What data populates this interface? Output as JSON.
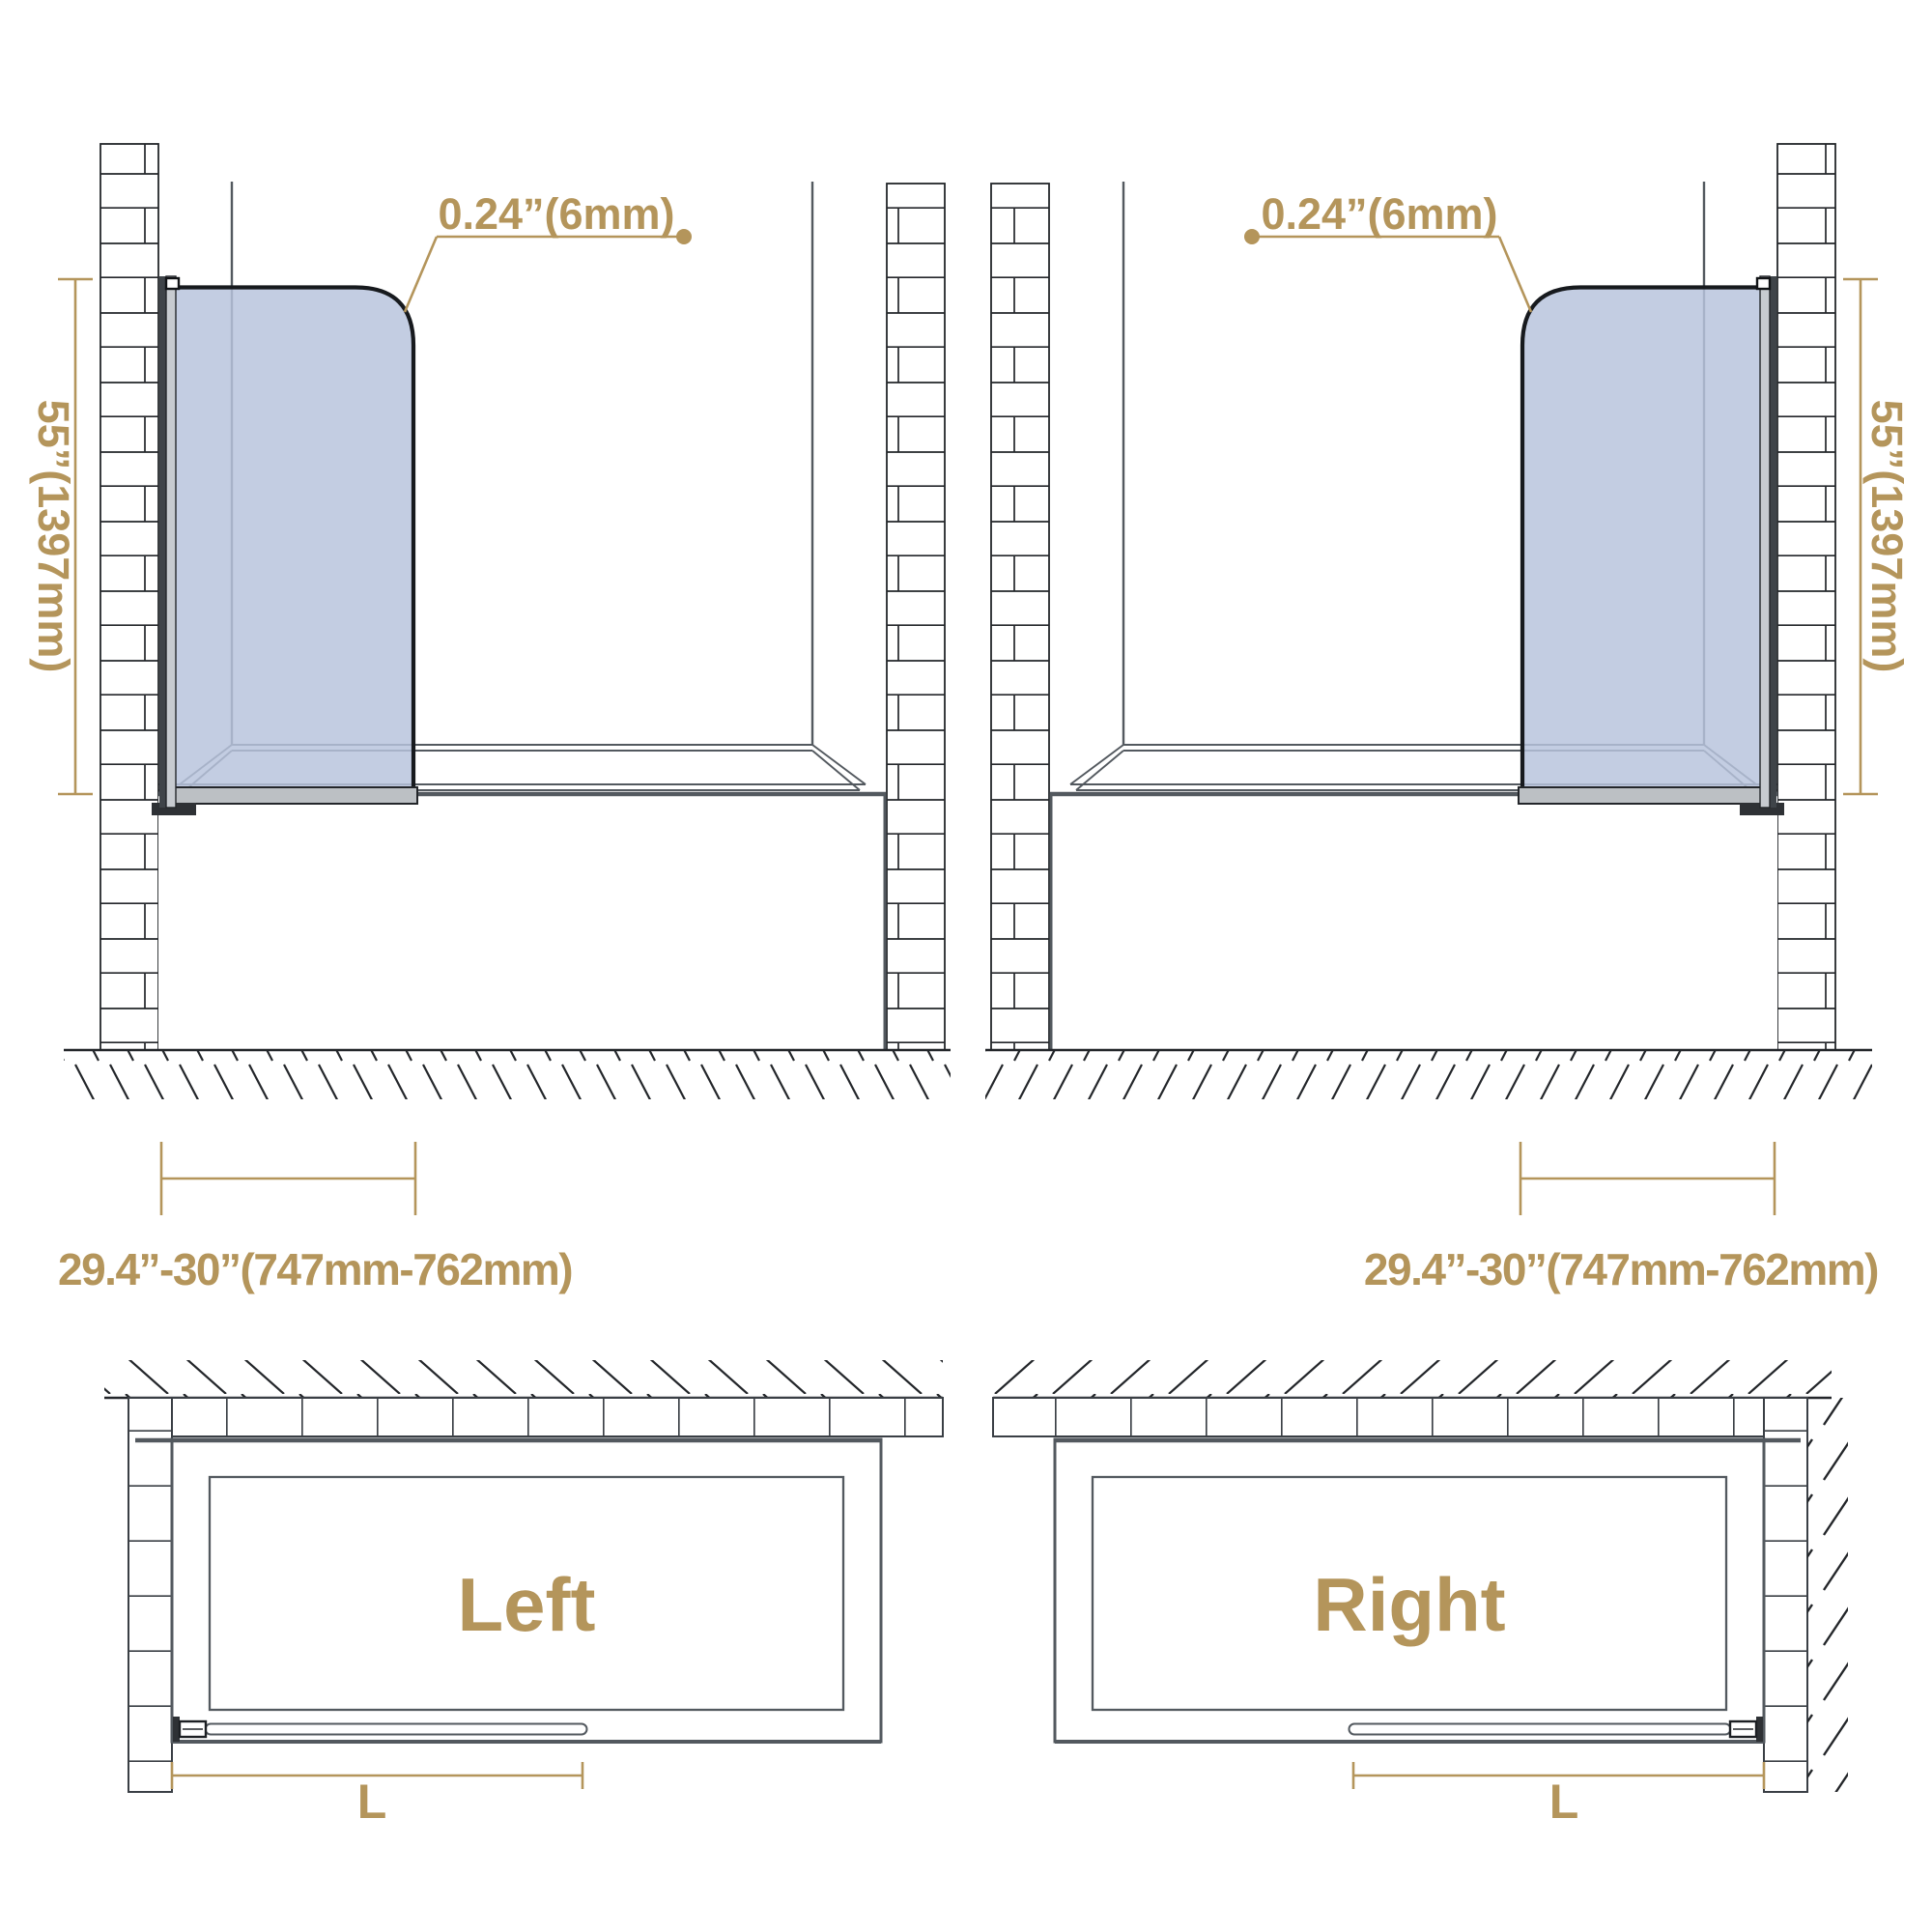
{
  "accent_color": "#b4955b",
  "glass_color": "#b7c3dc",
  "side_view_left": {
    "thickness_label": "0.24”(6mm)",
    "height_label": "55”(1397mm)",
    "width_label": "29.4”-30”(747mm-762mm)"
  },
  "side_view_right": {
    "thickness_label": "0.24”(6mm)",
    "height_label": "55”(1397mm)",
    "width_label": "29.4”-30”(747mm-762mm)"
  },
  "plan_view_left": {
    "title": "Left",
    "length_label": "L"
  },
  "plan_view_right": {
    "title": "Right",
    "length_label": "L"
  }
}
